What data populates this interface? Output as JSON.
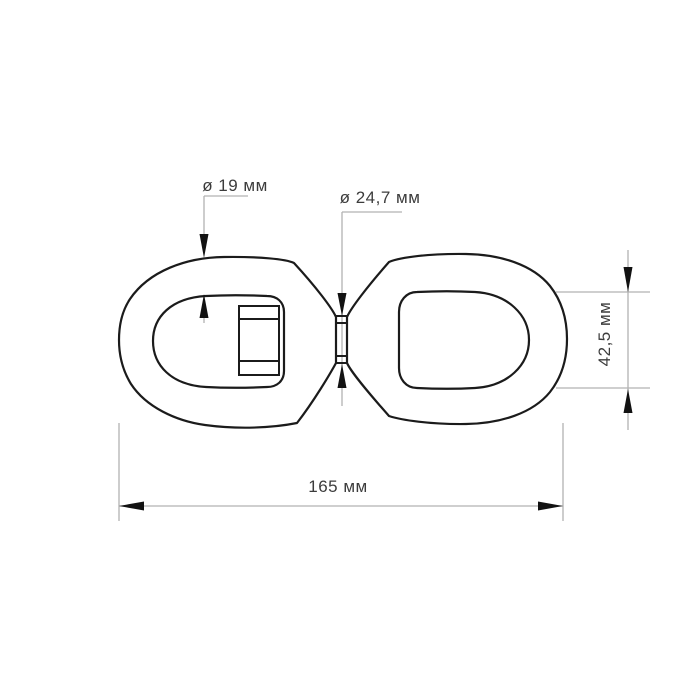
{
  "drawing": {
    "subject": "double-eye-swivel-side-view",
    "dims": {
      "rod_diameter": {
        "label": "ø 19 мм"
      },
      "pin_diameter": {
        "label": "ø 24,7 мм"
      },
      "eye_height": {
        "label": "42,5 мм"
      },
      "overall_length": {
        "label": "165 мм"
      }
    }
  },
  "colors": {
    "bg": "#ffffff",
    "outline": "#1b1b1b",
    "thin": "#b2b2b2",
    "arrow": "#121212",
    "text": "#3c3c3c"
  }
}
